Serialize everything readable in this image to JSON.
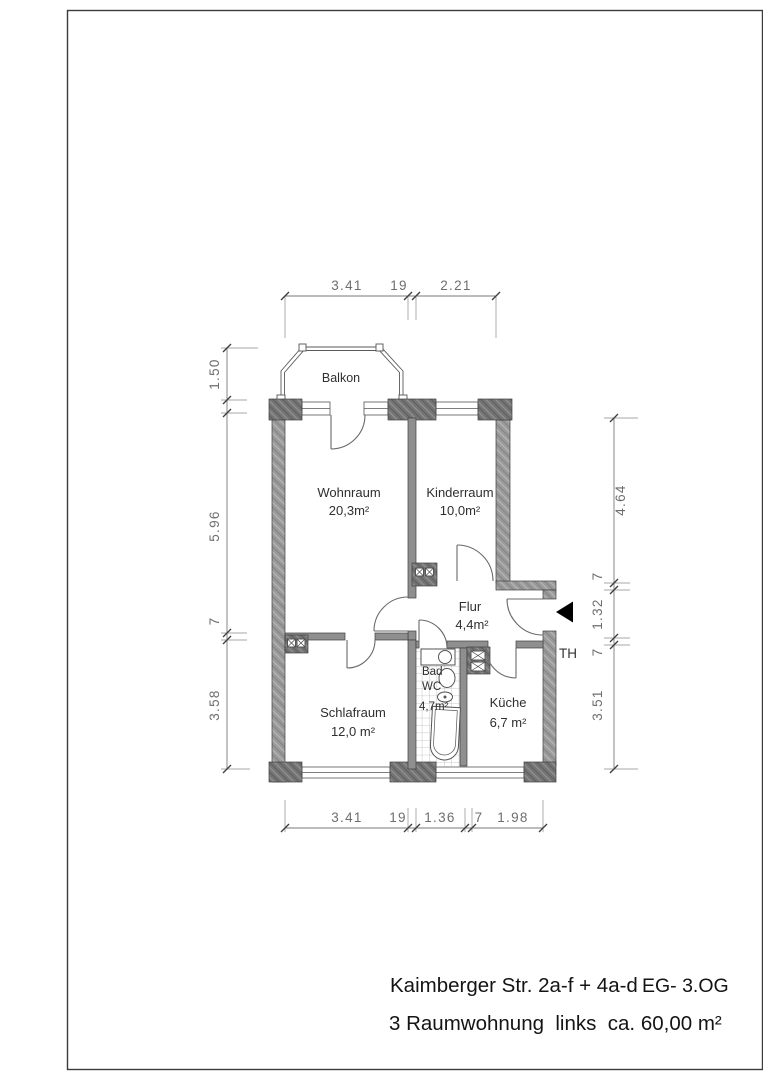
{
  "plan": {
    "rooms": {
      "balkon": {
        "name": "Balkon"
      },
      "wohnraum": {
        "name": "Wohnraum",
        "area": "20,3m²"
      },
      "kinderraum": {
        "name": "Kinderraum",
        "area": "10,0m²"
      },
      "flur": {
        "name": "Flur",
        "area": "4,4m²"
      },
      "bad": {
        "name": "Bad",
        "name2": "WC",
        "area": "4,7m²"
      },
      "schlafraum": {
        "name": "Schlafraum",
        "area": "12,0 m²"
      },
      "kueche": {
        "name": "Küche",
        "area": "6,7 m²"
      }
    },
    "stairwell_label": "TH",
    "dimensions": {
      "top": {
        "d1": "3.41",
        "d2": "19",
        "d3": "2.21"
      },
      "bottom": {
        "d1": "3.41",
        "d2": "19",
        "d3": "1.36",
        "d4": "7",
        "d5": "1.98"
      },
      "left": {
        "d1": "1.50",
        "d2": "5.96",
        "d3": "7",
        "d4": "3.58"
      },
      "right": {
        "d1": "4.64",
        "d2": "7",
        "d3": "1.32",
        "d4": "7",
        "d5": "3.51"
      }
    },
    "icons": {
      "entrance_arrow": "entrance-direction-triangle",
      "shaft_symbol": "crossed-box-shaft"
    },
    "colors": {
      "wall_fill": "#9a9a9a",
      "pier_fill": "#757575",
      "outline": "#3f3f3f",
      "dim_text": "#6e6e6e",
      "title_text": "#141414"
    }
  },
  "title_block": {
    "address": "Kaimberger Str. 2a-f + 4a-d",
    "floors": "EG- 3.OG",
    "description": "3 Raumwohnung  links  ca. 60,00 m²"
  }
}
